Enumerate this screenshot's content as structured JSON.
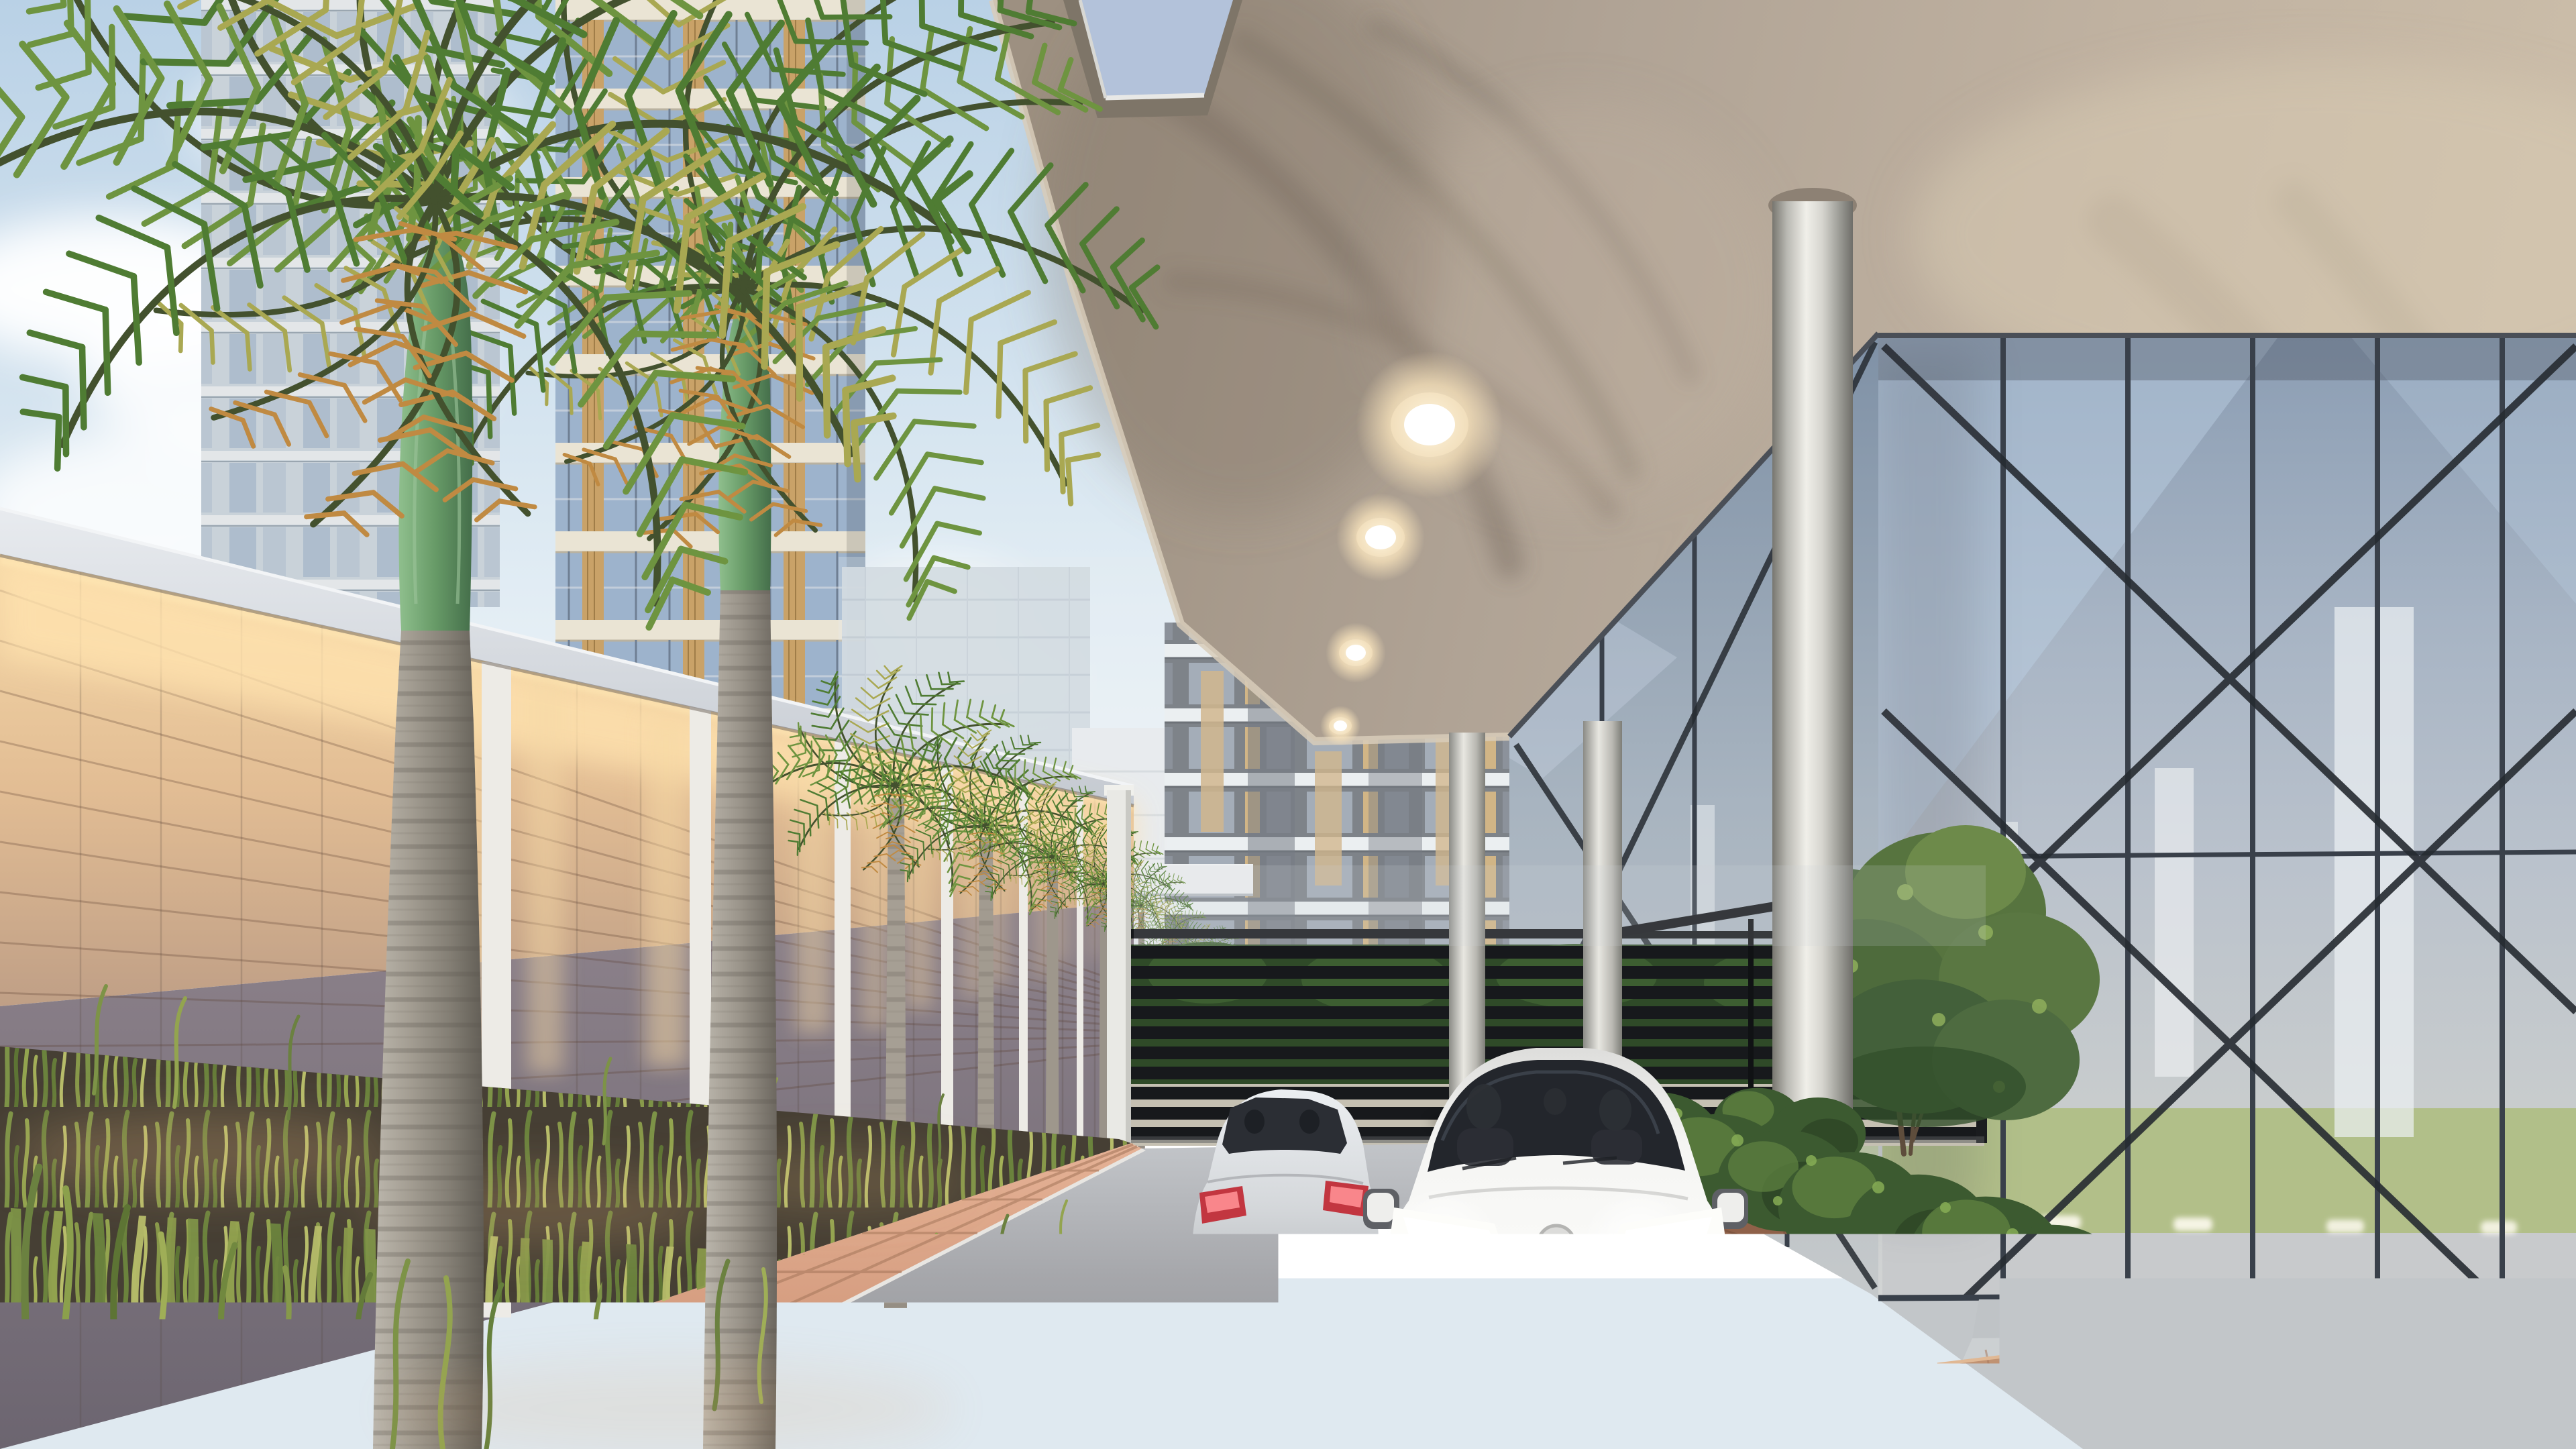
{
  "meta": {
    "title": "Architectural 3D rendering - residential complex entrance driveway",
    "kind": "photoreal-render",
    "time_of_day": "dusk with accent lighting on"
  },
  "scene": {
    "description": "A private driveway lined with royal palms along an up-lit stone boundary wall leads past a black slatted entrance gate; two cars (a white hatchback facing the viewer with headlights on, and a silver hatchback ahead seen from the rear) drive under a concrete drop-off canopy with recessed downlights, supported by round steel columns beside a glazed lobby facade with X cross-bracing; high-rise apartment towers with balconies rise in the background.",
    "elements": [
      {
        "name": "sky",
        "desc": "pale blue sky with soft clouds, upper left"
      },
      {
        "name": "apartment-tower-a",
        "desc": "glass apartment tower behind foreground palm"
      },
      {
        "name": "apartment-tower-b",
        "desc": "cream balcony tower with blue glass railings and wood accents"
      },
      {
        "name": "distant-buildings",
        "desc": "hazy mid-rise blocks near vanishing point"
      },
      {
        "name": "dark-apartment-tower",
        "desc": "dark grey tower with white balcony slabs beyond the gate"
      },
      {
        "name": "perimeter-wall",
        "desc": "stone block boundary wall, warm LED wash lighting under white coping, white pilasters"
      },
      {
        "name": "royal-palms",
        "desc": "row of 7 royal palm trees receding along the wall",
        "count": 7
      },
      {
        "name": "entrance-gate",
        "desc": "black horizontal-slat sliding gate with end pillar"
      },
      {
        "name": "driveway",
        "desc": "grey asphalt drive"
      },
      {
        "name": "paver-walkway",
        "desc": "salmon brick paver edge strip"
      },
      {
        "name": "grass-bed",
        "desc": "tall ornamental grasses at wall base"
      },
      {
        "name": "white-car",
        "desc": "white hybrid hatchback facing viewer, two occupants, headlights and fog lights on"
      },
      {
        "name": "silver-car",
        "desc": "silver hatchback ahead, rear view, tail lights lit"
      },
      {
        "name": "drop-off-canopy",
        "desc": "beige concrete canopy soffit with skylight opening, palm frond shadows and 4 recessed downlights",
        "downlights": 4
      },
      {
        "name": "round-columns",
        "desc": "cylindrical steel columns supporting canopy",
        "count": 3
      },
      {
        "name": "lobby-glass-facade",
        "desc": "full-height glazing with dark mullions and diagonal X cross-bracing; olive-green interior feature wall and interior lights visible"
      },
      {
        "name": "entry-steps",
        "desc": "wide concrete steps up to lobby terrace"
      },
      {
        "name": "planter-bed",
        "desc": "brick-faced planter with dense shrubs along drive"
      },
      {
        "name": "ornamental-tree",
        "desc": "small leafy tree in front of the glazing"
      }
    ],
    "counts": {
      "palms": 7,
      "cars": 2,
      "downlights": 4,
      "columns": 3
    }
  },
  "palette": {
    "sky-top": "#b9d1e6",
    "cloud": "#ffffff",
    "canopy": "#b3a695",
    "canopy-edge": "#d8ccba",
    "wall-coping": "#dfe3e8",
    "pilaster": "#edebe6",
    "wall-lit": "#e9c79d",
    "wall-glow": "#ffe2ae",
    "wall-shadow": "#857a83",
    "trunk": "#a49e93",
    "crownshaft": "#679a67",
    "frond-a": "#4f7c33",
    "frond-b": "#6e9440",
    "frond-c": "#a9a852",
    "frond-d": "#c08a42",
    "tower-slab": "#eae4d4",
    "tower-glass": "#9db3cc",
    "wood": "#c9a268",
    "dark-tower": "#565a62",
    "mullion": "#39404a",
    "brace": "#262b31",
    "interior-green": "#adbc7c",
    "gate": "#17191c",
    "hedge": "#2f4a28",
    "road": "#8c8d91",
    "road-far": "#c4c7cb",
    "curb": "#efefec",
    "paver": "#d9a287",
    "paver-joint": "#a97a5e",
    "plaza": "#c2c6c9",
    "step": "#c6cacd",
    "planter-brick": "#8f6149",
    "soil": "#463f34",
    "grass": "#7d9347",
    "shrub": "#3c5a30",
    "shrub-light": "#5e8040",
    "column-light": "#f0efe9",
    "column-dark": "#6f6e69",
    "car-white": "#f5f5f3",
    "car-silver": "#d5d8db",
    "car-glass": "#2b2e34",
    "taillight": "#c23640",
    "headlight": "#ffffff",
    "downlight": "#fff3d8"
  }
}
